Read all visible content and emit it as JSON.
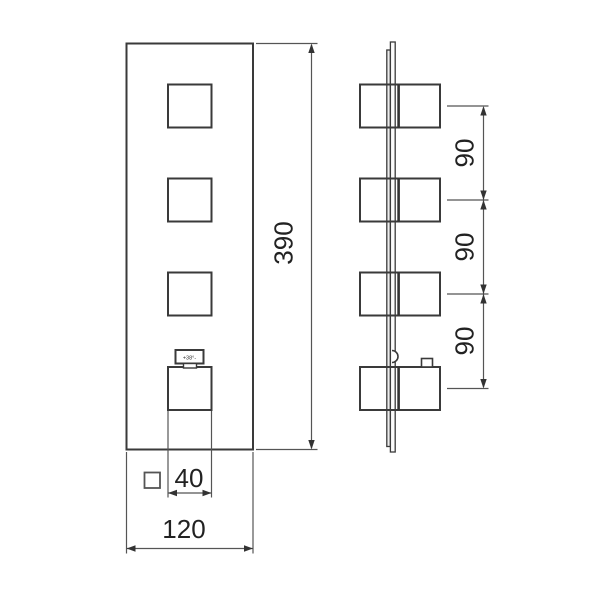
{
  "diagram": {
    "description": "technical-dimension-drawing",
    "dimensions": {
      "overall_height": "390",
      "overall_width": "120",
      "handle_size": "40",
      "handle_spacings": [
        "90",
        "90",
        "90"
      ]
    },
    "temperature_indicator": {
      "label": "+38°-"
    },
    "icons": {
      "square_section_symbol": "square-outline"
    },
    "colors": {
      "object_line": "#3a3a3a",
      "dimension_line": "#555555",
      "text": "#222222",
      "background": "#ffffff"
    }
  }
}
